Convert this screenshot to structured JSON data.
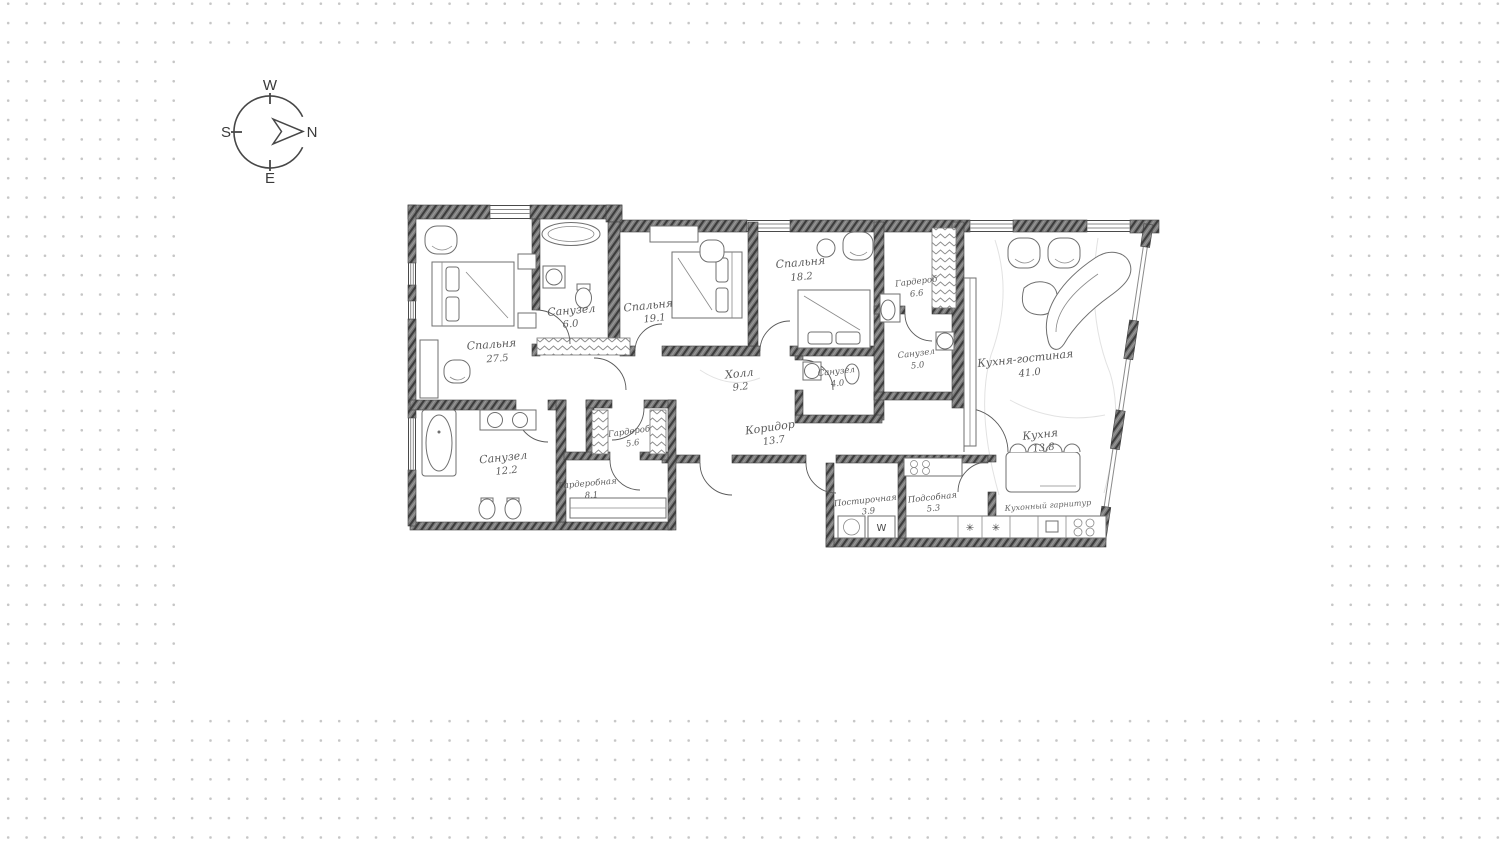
{
  "compass": {
    "top": "W",
    "right": "N",
    "left": "S",
    "bottom": "E"
  },
  "rooms": {
    "bedroom_1": {
      "name": "Спальня",
      "area": "27.5"
    },
    "bath_1": {
      "name": "Санузел",
      "area": "6.0"
    },
    "bedroom_2": {
      "name": "Спальня",
      "area": "19.1"
    },
    "bedroom_3": {
      "name": "Спальня",
      "area": "18.2"
    },
    "wardrobe_1": {
      "name": "Гардероб",
      "area": "6.6"
    },
    "bath_2": {
      "name": "Санузел",
      "area": "5.0"
    },
    "kitchen_living": {
      "name": "Кухня-гостиная",
      "area": "41.0"
    },
    "hall": {
      "name": "Холл",
      "area": "9.2"
    },
    "bath_3": {
      "name": "Санузел",
      "area": "4.0"
    },
    "corridor": {
      "name": "Коридор",
      "area": "13.7"
    },
    "wardrobe_2": {
      "name": "Гардероб",
      "area": "5.6"
    },
    "bath_4": {
      "name": "Санузел",
      "area": "12.2"
    },
    "walk_in_closet": {
      "name": "Гардеробная",
      "area": "8.1"
    },
    "laundry": {
      "name": "Постирочная",
      "area": "3.9"
    },
    "utility": {
      "name": "Подсобная",
      "area": "5.3"
    },
    "kitchen": {
      "name": "Кухня",
      "area": "13.8"
    }
  },
  "annotations": {
    "kitchen_set": "Кухонный гарнитур"
  },
  "symbols": {
    "washer": "W",
    "snowflake": "✳"
  },
  "colors": {
    "ink": "#3f3f3f",
    "furniture": "#6f6f6f",
    "label": "#5c5c5c",
    "dot": "#c6c6c6"
  }
}
